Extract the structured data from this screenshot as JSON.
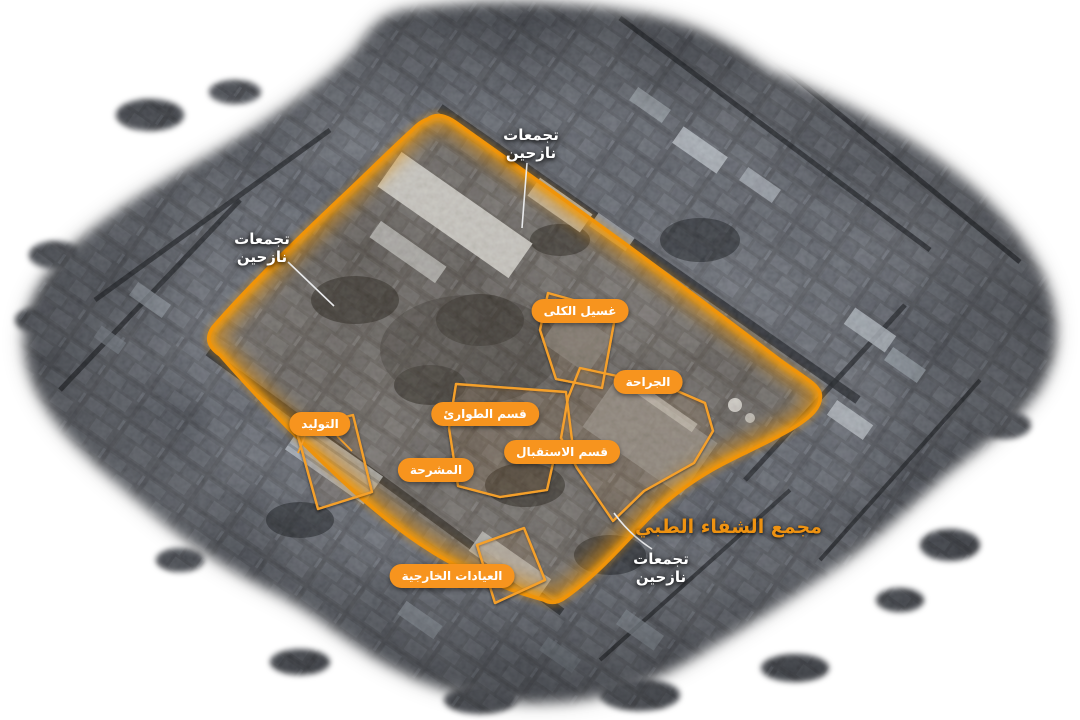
{
  "canvas": {
    "width": 1080,
    "height": 720,
    "background": "#FFFFFF"
  },
  "title": {
    "text": "مجمع الشفاء الطبي",
    "color": "#EE9211"
  },
  "facilities": {
    "dialysis": "غسيل الكلى",
    "surgery": "الجراحة",
    "emergency": "قسم الطوارئ",
    "reception": "قسم الاستقبال",
    "morgue": "المشرحة",
    "obstetrics": "التوليد",
    "outpatient_clinics": "العيادات الخارجية"
  },
  "displaced_label": {
    "line1": "تجمعات",
    "line2": "نازحين"
  },
  "colors": {
    "facility_pill": "#F7941E",
    "pill_text": "#FFFFFF",
    "boundary_orange": "#F09409",
    "building_outline_orange": "#F5A02C",
    "area_label_text": "#FFFFFF"
  }
}
